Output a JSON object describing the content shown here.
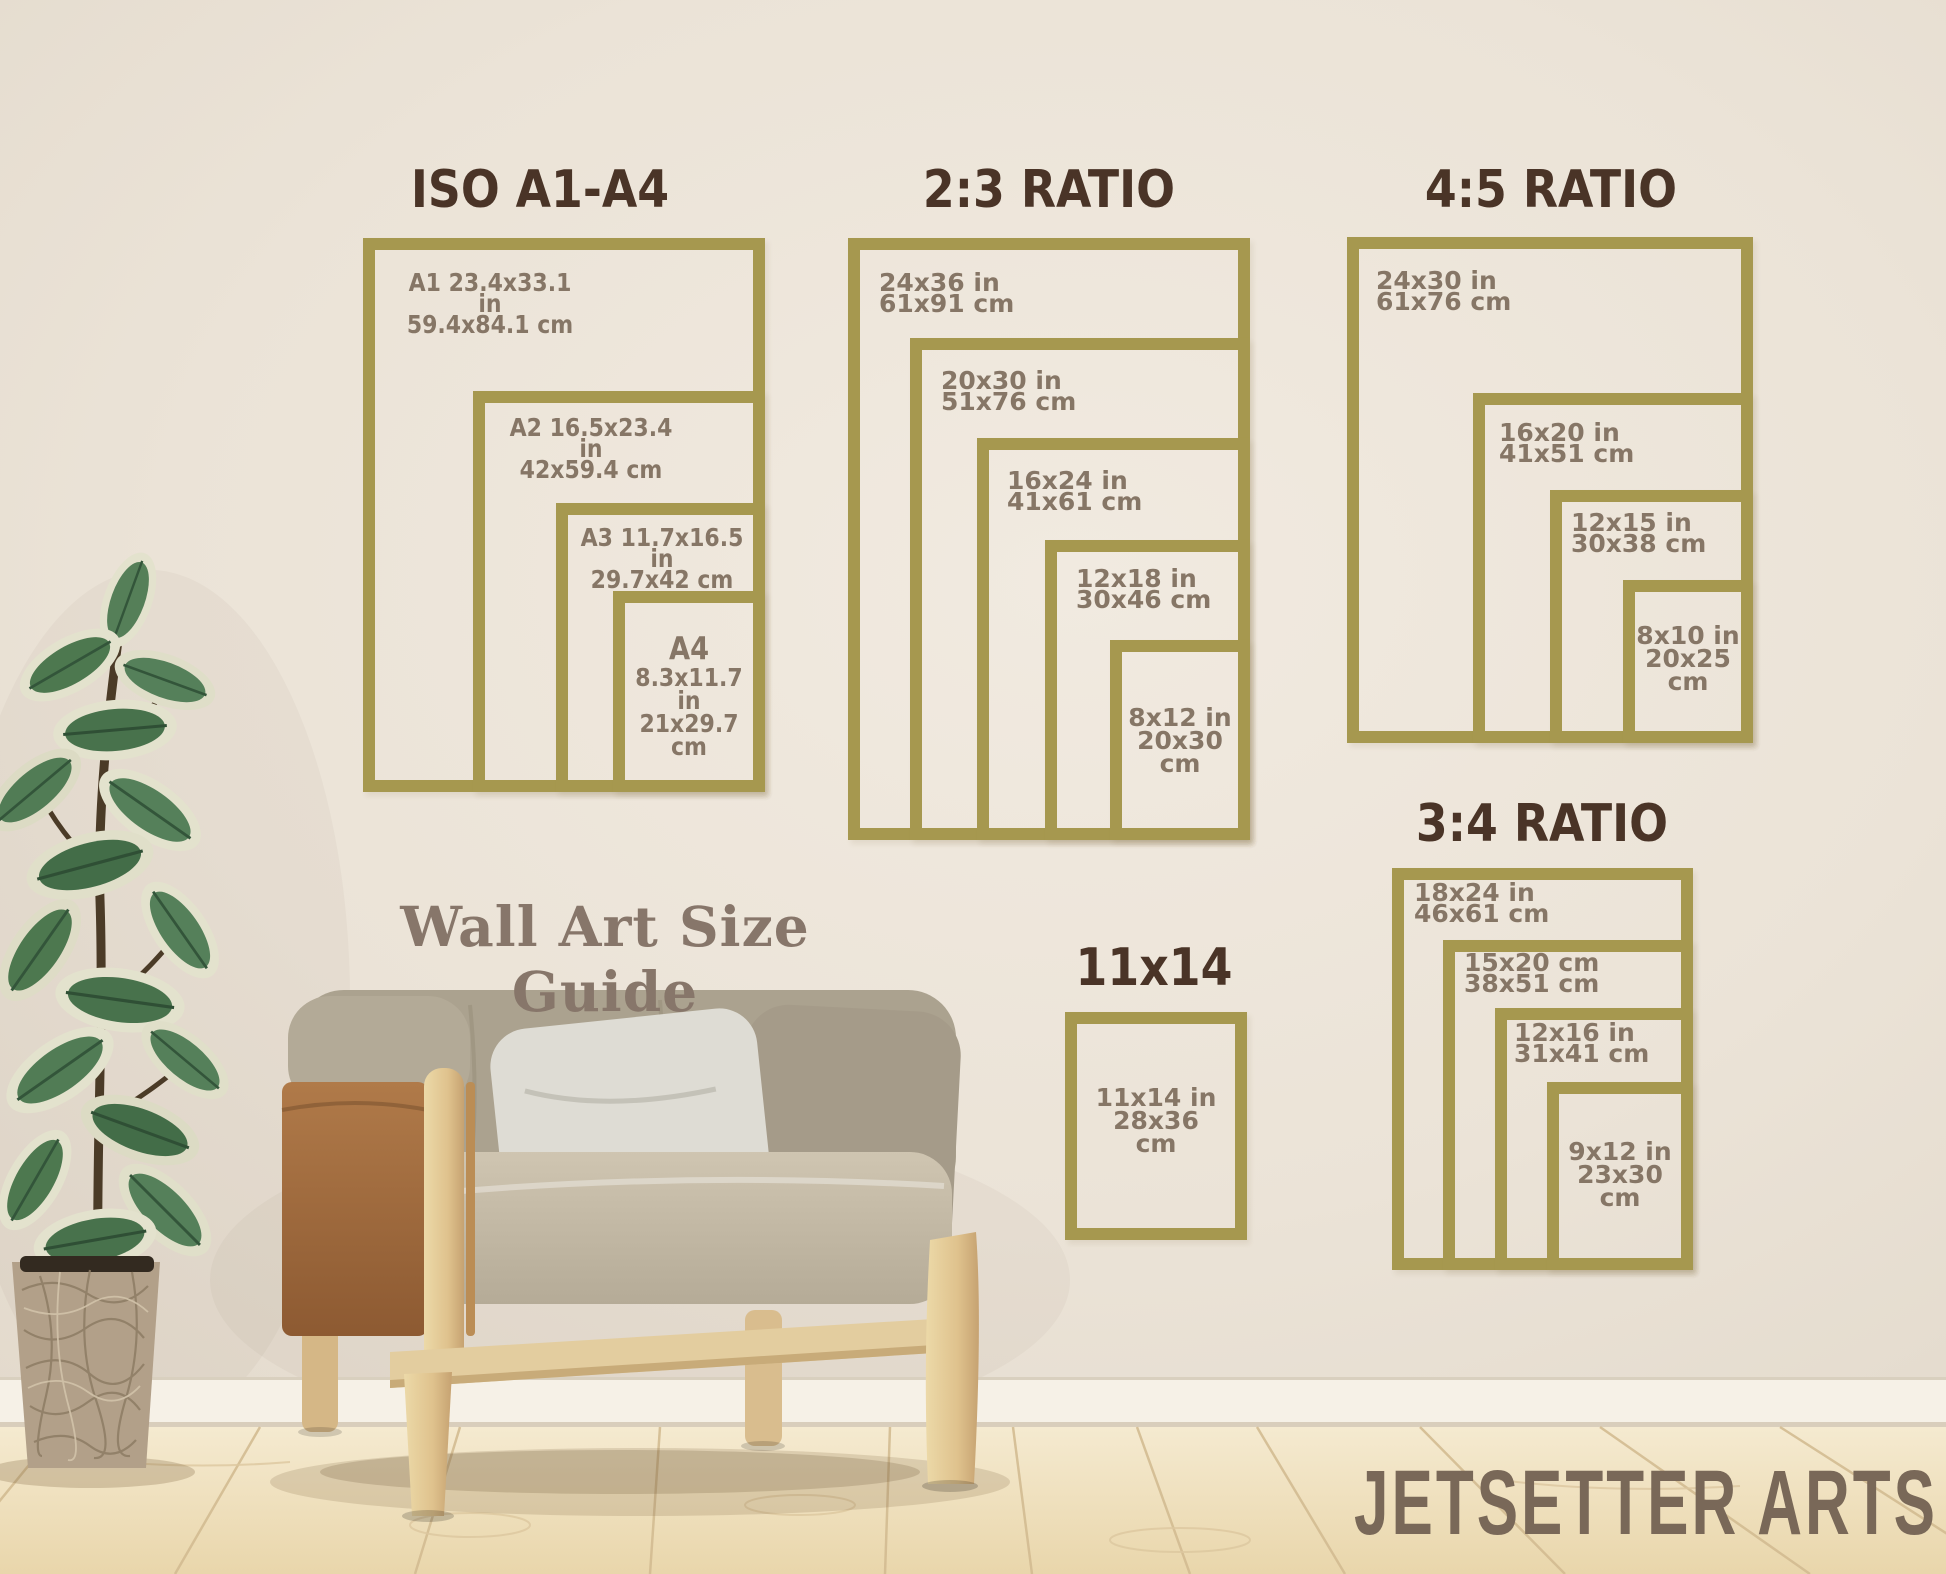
{
  "guide": {
    "caption": "Wall Art Size Guide",
    "brand": "JETSETTER ARTS",
    "panels": {
      "iso": {
        "title": "ISO A1-A4",
        "sizes": {
          "a1": {
            "lines": [
              "A1 23.4x33.1 in",
              "59.4x84.1 cm"
            ]
          },
          "a2": {
            "lines": [
              "A2 16.5x23.4 in",
              "42x59.4 cm"
            ]
          },
          "a3": {
            "lines": [
              "A3 11.7x16.5 in",
              "29.7x42 cm"
            ]
          },
          "a4": {
            "name": "A4",
            "lines": [
              "8.3x11.7 in",
              "21x29.7",
              "cm"
            ]
          }
        }
      },
      "r23": {
        "title": "2:3 RATIO",
        "sizes": {
          "s24x36": {
            "lines": [
              "24x36 in",
              "61x91 cm"
            ]
          },
          "s20x30": {
            "lines": [
              "20x30 in",
              "51x76 cm"
            ]
          },
          "s16x24": {
            "lines": [
              "16x24 in",
              "41x61 cm"
            ]
          },
          "s12x18": {
            "lines": [
              "12x18 in",
              "30x46 cm"
            ]
          },
          "s8x12": {
            "lines": [
              "8x12 in",
              "20x30",
              "cm"
            ]
          }
        }
      },
      "r45": {
        "title": "4:5 RATIO",
        "sizes": {
          "s24x30": {
            "lines": [
              "24x30 in",
              "61x76 cm"
            ]
          },
          "s16x20": {
            "lines": [
              "16x20 in",
              "41x51 cm"
            ]
          },
          "s12x15": {
            "lines": [
              "12x15 in",
              "30x38 cm"
            ]
          },
          "s8x10": {
            "lines": [
              "8x10 in",
              "20x25",
              "cm"
            ]
          }
        }
      },
      "r34": {
        "title": "3:4 RATIO",
        "sizes": {
          "s18x24": {
            "lines": [
              "18x24 in",
              "46x61 cm"
            ]
          },
          "s15x20": {
            "lines": [
              "15x20 cm",
              "38x51 cm"
            ]
          },
          "s12x16": {
            "lines": [
              "12x16 in",
              "31x41 cm"
            ]
          },
          "s9x12": {
            "lines": [
              "9x12 in",
              "23x30",
              "cm"
            ]
          }
        }
      },
      "r11x14": {
        "title": "11x14",
        "sizes": {
          "s11x14": {
            "lines": [
              "11x14 in",
              "28x36",
              "cm"
            ]
          }
        }
      }
    }
  },
  "colors": {
    "frame_gold": "#a6984f",
    "title_brown": "#4a3427",
    "label_taupe": "#867666",
    "wall_cream": "#ebe3d8",
    "floor_wood": "#eedcb6",
    "leather_tan": "#a9713f",
    "chair_fabric": "#aba28f",
    "brand_taupe": "#796858"
  }
}
